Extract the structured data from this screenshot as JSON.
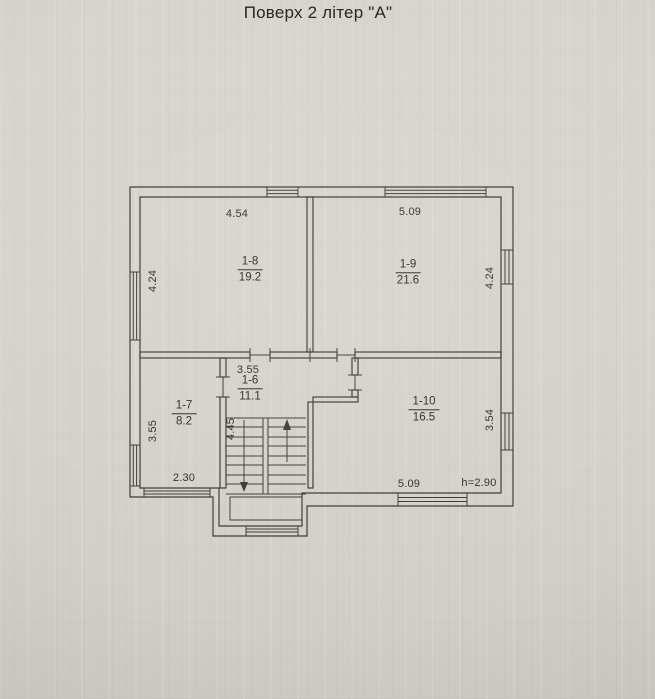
{
  "page": {
    "title": "Поверх 2 літер \"А\""
  },
  "plan": {
    "rooms": [
      {
        "id": "1-8",
        "area": "19.2"
      },
      {
        "id": "1-9",
        "area": "21.6"
      },
      {
        "id": "1-6",
        "area": "11.1"
      },
      {
        "id": "1-7",
        "area": "8.2"
      },
      {
        "id": "1-10",
        "area": "16.5"
      }
    ],
    "dims": {
      "top_left_width": "4.54",
      "top_right_width": "5.09",
      "left_upper_height": "4.24",
      "right_upper_height": "4.24",
      "hall_width": "3.55",
      "left_lower_height": "3.55",
      "stair_depth": "4.45",
      "bottom_left_width": "2.30",
      "bottom_right_width": "5.09",
      "right_lower_height": "3.54",
      "ceiling_height": "h=2.90"
    },
    "colors": {
      "paper": "#d5d2cb",
      "ink": "#39362f"
    }
  }
}
